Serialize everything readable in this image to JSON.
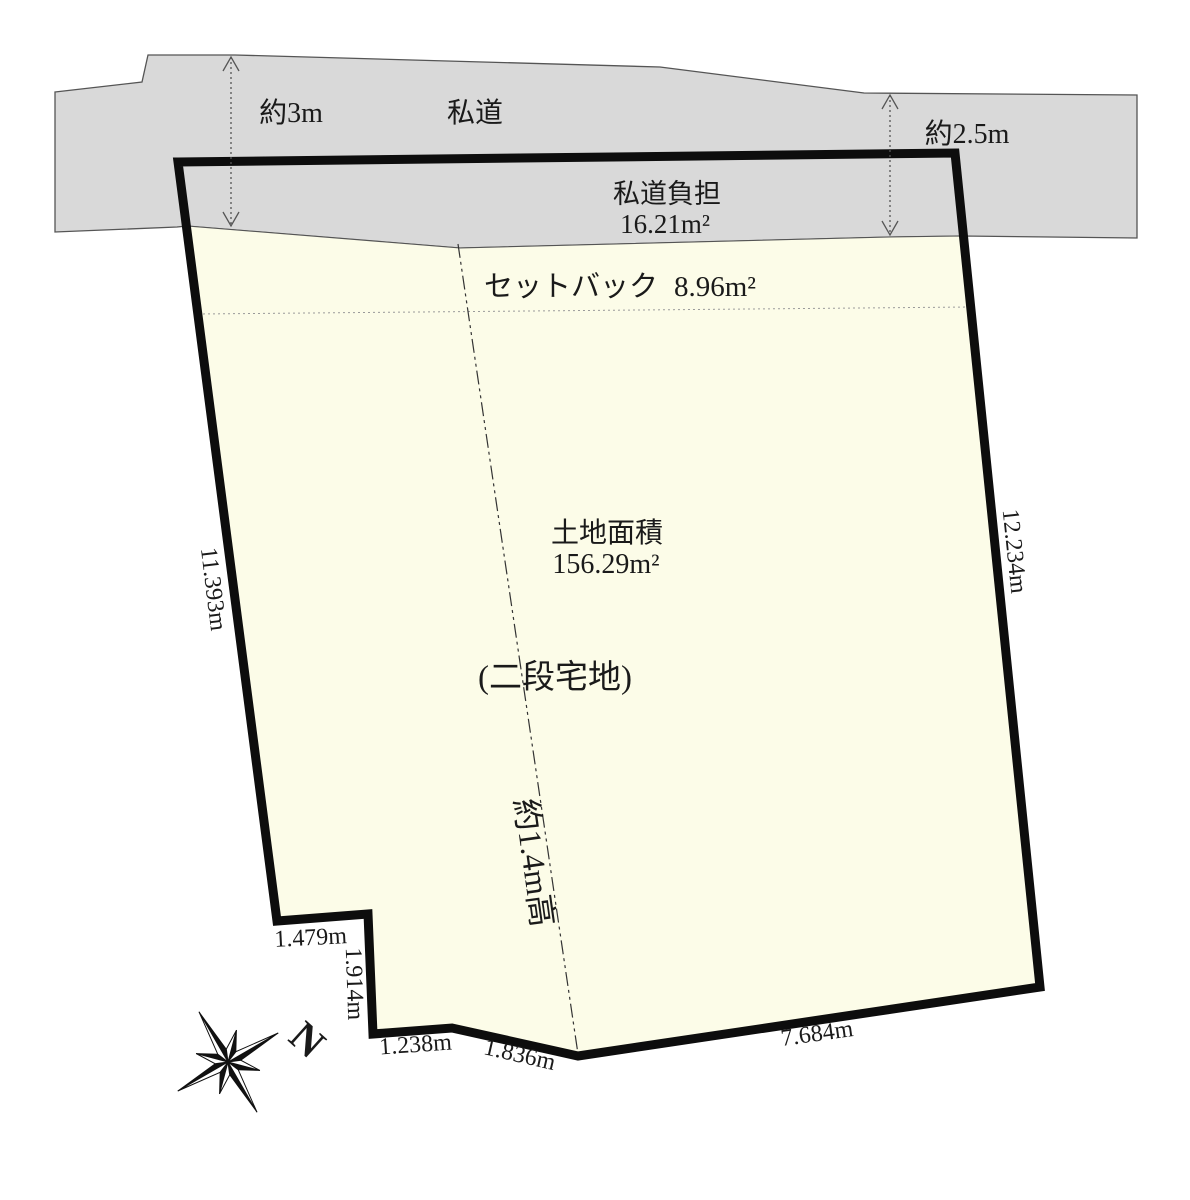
{
  "diagram": {
    "road": {
      "label": "私道",
      "width_left": "約3m",
      "width_right": "約2.5m",
      "burden_label": "私道負担",
      "burden_area": "16.21m²"
    },
    "setback": {
      "label": "セットバック",
      "area": "8.96m²"
    },
    "plot": {
      "area_label": "土地面積",
      "area_value": "156.29m²",
      "note": "(二段宅地)",
      "step_note": "約1.4m高"
    },
    "edges": {
      "left": "11.393m",
      "right": "12.234m",
      "notch_top": "1.479m",
      "notch_side": "1.914m",
      "bottom_left": "1.238m",
      "bottom_mid": "1.836m",
      "bottom_right": "7.684m"
    },
    "compass": {
      "north_label": "N"
    },
    "colors": {
      "road_fill": "#d9d9d9",
      "plot_fill": "#fcfce8",
      "boundary": "#0d0d0d"
    }
  }
}
